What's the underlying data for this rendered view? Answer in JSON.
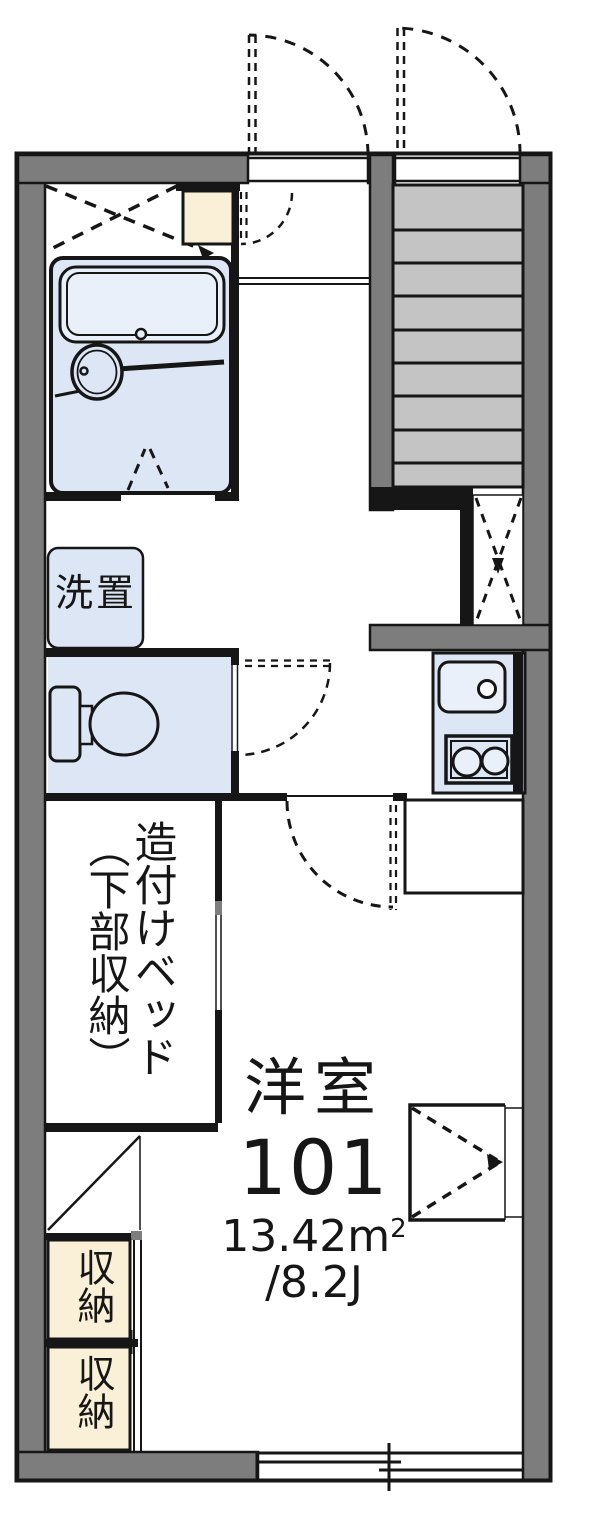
{
  "title": "room-101-floor-plan",
  "colors": {
    "wall": "#7d7d7d",
    "tread": "#c4c4c4",
    "fixture": "#dce6f5",
    "fixture_light": "#eaf0fa",
    "cream": "#faf0d8",
    "ink": "#161616",
    "paper": "#ffffff"
  },
  "labels": {
    "washer": "洗置",
    "bed_line1": "造付けベッド",
    "bed_line2": "（下部収納）",
    "storage1": "収納",
    "storage2": "収納",
    "room_name": "洋室",
    "room_number": "101",
    "area_main": "13.42m",
    "area_sup": "2",
    "tatami": "/8.2J"
  }
}
